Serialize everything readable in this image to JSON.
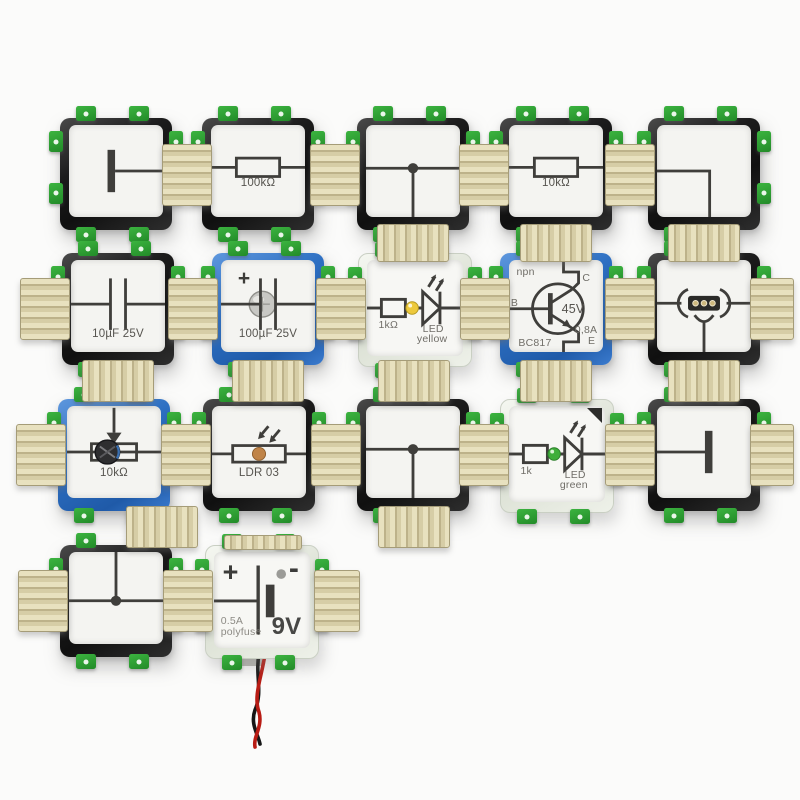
{
  "scene": {
    "type": "product-photo",
    "subject": "electronic circuit building bricks arranged on a white surface",
    "background_color": "#fbfbfa"
  },
  "colors": {
    "frame_black": "#1c1c1c",
    "frame_blue": "#2d6fc2",
    "frame_clear": "#e6eae0",
    "face_white": "#f4f4f1",
    "symbol_ink": "#3f3e3b",
    "pcb_tab_green": "#2fa233",
    "connector_beige": "#d6cda6",
    "led_yellow": "#edc93c",
    "led_green": "#3fae3a",
    "ldr_disc_orange": "#c08448",
    "wire_red": "#b81c14",
    "wire_black": "#161616"
  },
  "bricks": [
    {
      "name": "wire-terminal-right",
      "frame": "black",
      "labels": {}
    },
    {
      "name": "resistor-100k",
      "frame": "black",
      "labels": {
        "value": "100kΩ"
      }
    },
    {
      "name": "wire-t-junction-down",
      "frame": "black",
      "labels": {}
    },
    {
      "name": "resistor-10k",
      "frame": "black",
      "labels": {
        "value": "10kΩ"
      }
    },
    {
      "name": "wire-corner-left-down",
      "frame": "black",
      "labels": {}
    },
    {
      "name": "capacitor-10uf",
      "frame": "black",
      "labels": {
        "value": "10µF 25V"
      }
    },
    {
      "name": "capacitor-100uf-polarized",
      "frame": "blue",
      "labels": {
        "plus": "+",
        "value": "100µF 25V"
      }
    },
    {
      "name": "led-yellow-with-resistor",
      "frame": "clear",
      "labels": {
        "resistor": "1kΩ",
        "led_line1": "LED",
        "led_line2": "yellow"
      }
    },
    {
      "name": "transistor-npn-bc817",
      "frame": "blue",
      "labels": {
        "type": "npn",
        "collector": "C",
        "base": "B",
        "voltage": "45V",
        "current": "0,8A",
        "emitter": "E",
        "part": "BC817"
      }
    },
    {
      "name": "measurement-socket",
      "frame": "black",
      "labels": {}
    },
    {
      "name": "potentiometer-10k",
      "frame": "blue",
      "labels": {
        "value": "10kΩ"
      }
    },
    {
      "name": "ldr-photoresistor",
      "frame": "black",
      "labels": {
        "value": "LDR 03"
      }
    },
    {
      "name": "wire-t-junction-down-2",
      "frame": "black",
      "labels": {}
    },
    {
      "name": "led-green-with-resistor",
      "frame": "clear",
      "labels": {
        "resistor": "1k",
        "led_line1": "LED",
        "led_line2": "green"
      }
    },
    {
      "name": "wire-terminal-left",
      "frame": "black",
      "labels": {}
    },
    {
      "name": "wire-t-junction-up",
      "frame": "black",
      "labels": {}
    },
    {
      "name": "battery-9v",
      "frame": "clear",
      "labels": {
        "plus": "+",
        "minus": "-",
        "fuse_line1": "0.5A",
        "fuse_line2": "polyfuse",
        "voltage": "9V"
      }
    }
  ]
}
